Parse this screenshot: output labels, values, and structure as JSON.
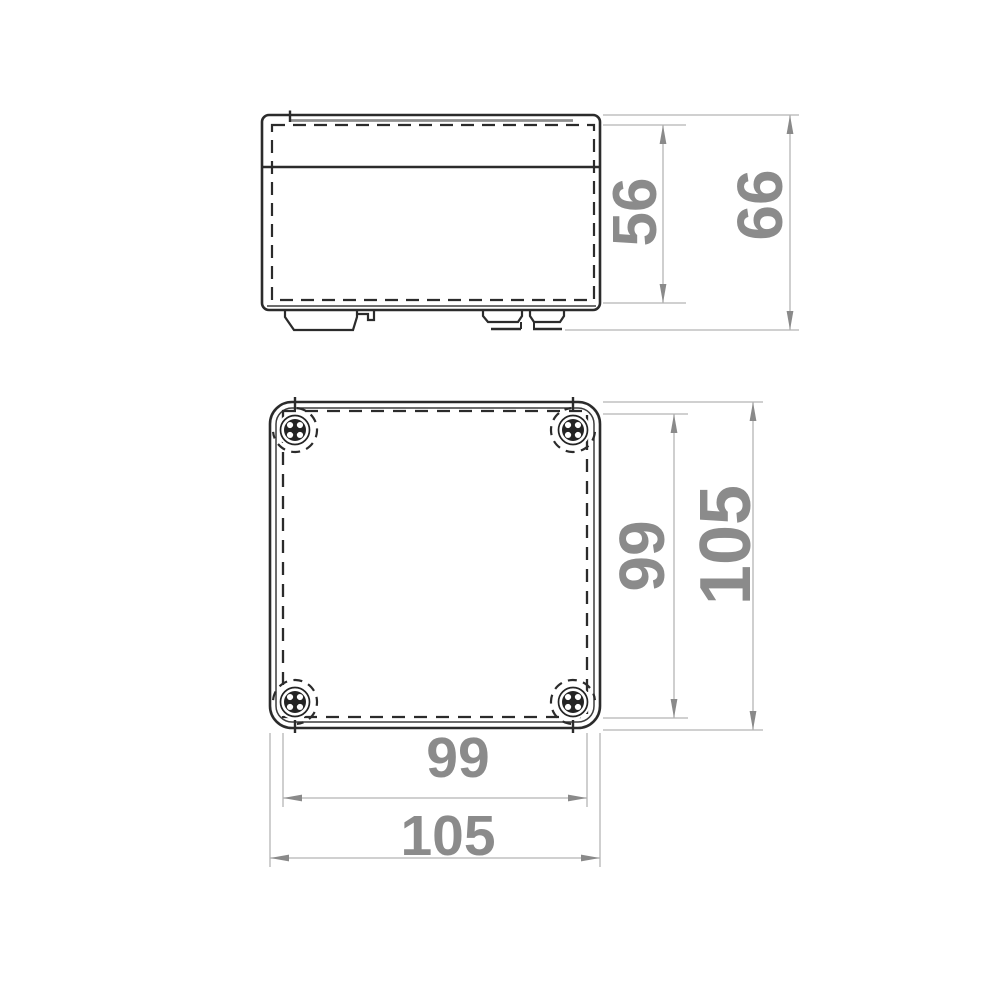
{
  "drawing": {
    "type": "technical dimension drawing",
    "subject": "square junction box enclosure shown in two orthographic views (side elevation with lid and mounting tabs, front face with four corner screws)",
    "units": "mm",
    "colors": {
      "background": "#ffffff",
      "outline": "#2b2b2b",
      "dimension_line": "#b5b5b5",
      "arrow": "#8a8a8a",
      "dimension_text": "#8b8b8b"
    },
    "side_view": {
      "label": "side elevation",
      "dim_body_height": "56",
      "dim_overall_height": "66"
    },
    "front_view": {
      "label": "front view",
      "dim_inner_height": "99",
      "dim_overall_height": "105",
      "dim_inner_width": "99",
      "dim_overall_width": "105"
    }
  }
}
